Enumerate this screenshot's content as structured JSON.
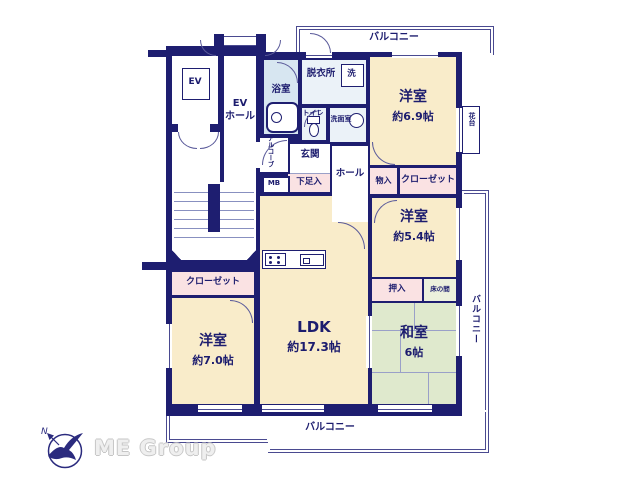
{
  "plan": {
    "balcony_top": "バルコニー",
    "balcony_right": "バルコニー",
    "balcony_bottom": "バルコニー",
    "elevator": "EV",
    "ev_hall_line1": "EV",
    "ev_hall_line2": "ホール",
    "bathroom": "浴室",
    "dressing_room": "脱衣所",
    "washer": "洗",
    "toilet": "トイレ",
    "washroom": "洗面室",
    "alcove": "アルコーブ",
    "entrance": "玄関",
    "meter_box": "MB",
    "shoe_cabinet": "下足入",
    "hall": "ホール",
    "storage": "物入",
    "closet_north": "クローゼット",
    "closet_west": "クローゼット",
    "flower_stand": "花台",
    "oshiire": "押入",
    "tokonoma": "床の間",
    "rooms": {
      "western_69": {
        "name": "洋室",
        "size": "約6.9帖"
      },
      "western_54": {
        "name": "洋室",
        "size": "約5.4帖"
      },
      "western_70": {
        "name": "洋室",
        "size": "約7.0帖"
      },
      "ldk": {
        "name": "LDK",
        "size": "約17.3帖"
      },
      "washitsu": {
        "name": "和室",
        "size": "6帖"
      }
    }
  },
  "branding": {
    "logo": "ME Group",
    "compass_north": "N"
  },
  "colors": {
    "wall": "#1e1e70",
    "western_room": "#f9ecca",
    "closet": "#fae2e3",
    "tatami_room": "#dfe9cd",
    "bathroom": "#d7e6f1",
    "sanitary": "#ebf2f8",
    "balcony_line": "#4a4a90",
    "text": "#1c1c6e",
    "logo_gray": "#efefef"
  }
}
